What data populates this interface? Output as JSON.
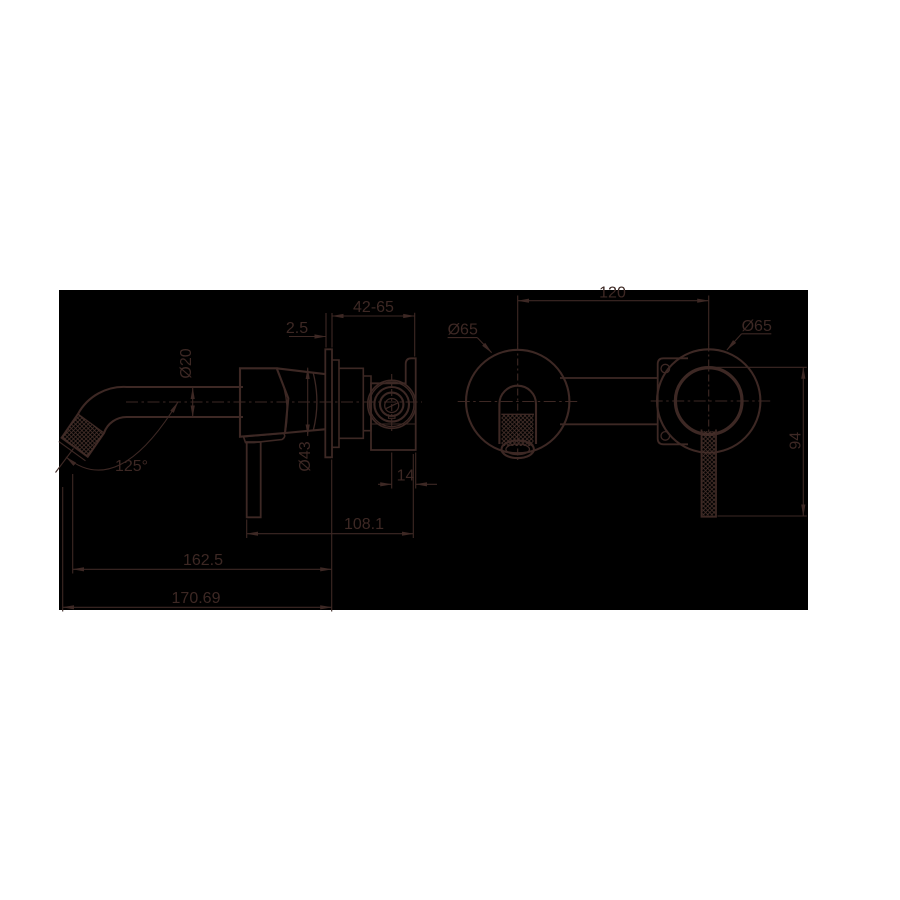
{
  "colors": {
    "page_background": "#ffffff",
    "panel_background": "#000000",
    "line": "#3d2824"
  },
  "side_view": {
    "dims": {
      "wall_depth": "42-65",
      "plate_thickness": "2.5",
      "spout_diameter": "Ø20",
      "spout_angle": "125°",
      "body_diameter": "Ø43",
      "handle_offset": "14",
      "spout_reach": "108.1",
      "projection_mid": "162.5",
      "projection_total": "170.69"
    }
  },
  "front_view": {
    "dims": {
      "centre_distance": "120",
      "spout_plate_diameter": "Ø65",
      "mixer_plate_diameter": "Ø65",
      "handle_drop": "94"
    }
  }
}
